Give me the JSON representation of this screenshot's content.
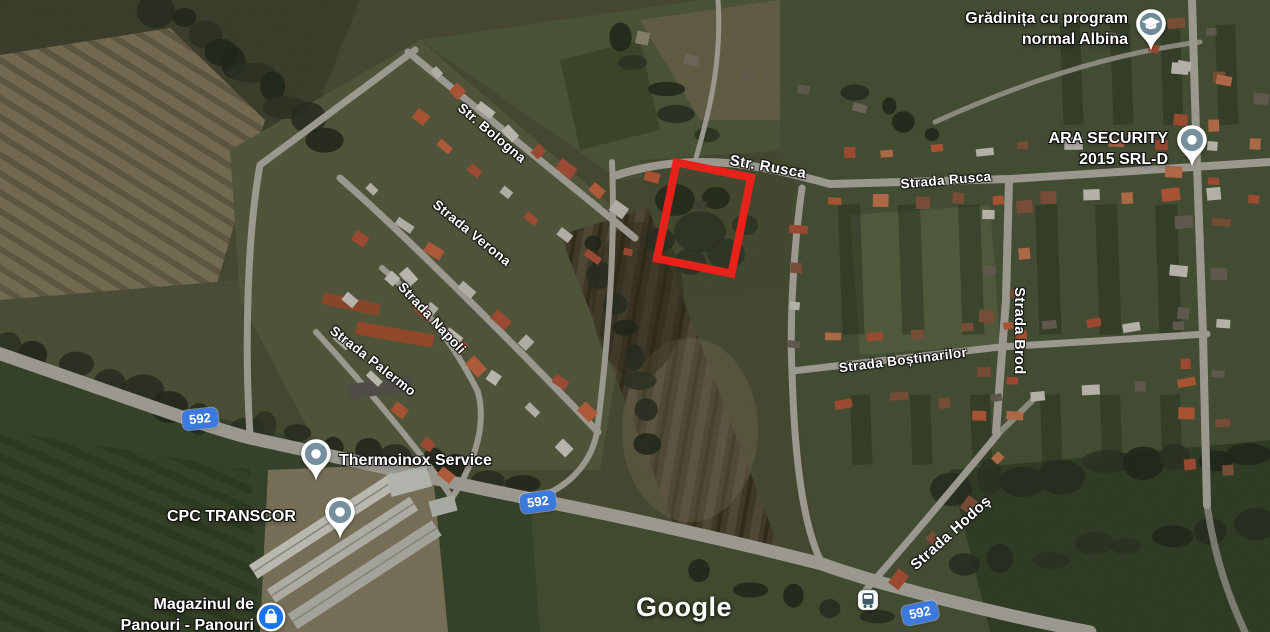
{
  "map": {
    "watermark": "Google",
    "parcel_highlight_color": "#e8221a",
    "road_shield_color": "#3c79dd",
    "street_labels": [
      {
        "id": "bologna",
        "text": "Str. Bologna"
      },
      {
        "id": "verona",
        "text": "Strada Verona"
      },
      {
        "id": "napoli",
        "text": "Strada Napoli"
      },
      {
        "id": "palermo",
        "text": "Strada Palermo"
      },
      {
        "id": "str-rusca",
        "text": "Str. Rusca"
      },
      {
        "id": "strada-rusca",
        "text": "Strada Rusca"
      },
      {
        "id": "bostinarilor",
        "text": "Strada Boștinarilor"
      },
      {
        "id": "brod",
        "text": "Strada Brod"
      },
      {
        "id": "hodos",
        "text": "Strada Hodoș"
      }
    ],
    "road_shields": [
      {
        "id": "west",
        "label": "592"
      },
      {
        "id": "mid",
        "label": "592"
      },
      {
        "id": "south",
        "label": "592"
      }
    ],
    "pois": [
      {
        "id": "gradinita",
        "icon": "school-pin-icon",
        "line1": "Grădinița cu program",
        "line2": "normal Albina"
      },
      {
        "id": "ara-security",
        "icon": "place-pin-icon",
        "line1": "ARA SECURITY",
        "line2": "2015 SRL-D"
      },
      {
        "id": "thermoinox",
        "icon": "place-pin-icon",
        "line1": "Thermoinox Service"
      },
      {
        "id": "cpc-transcor",
        "icon": "place-pin-icon",
        "line1": "CPC TRANSCOR"
      },
      {
        "id": "magazinul",
        "icon": "shopping-pin-icon",
        "line1": "Magazinul de",
        "line2": "Panouri - Panouri"
      }
    ]
  }
}
